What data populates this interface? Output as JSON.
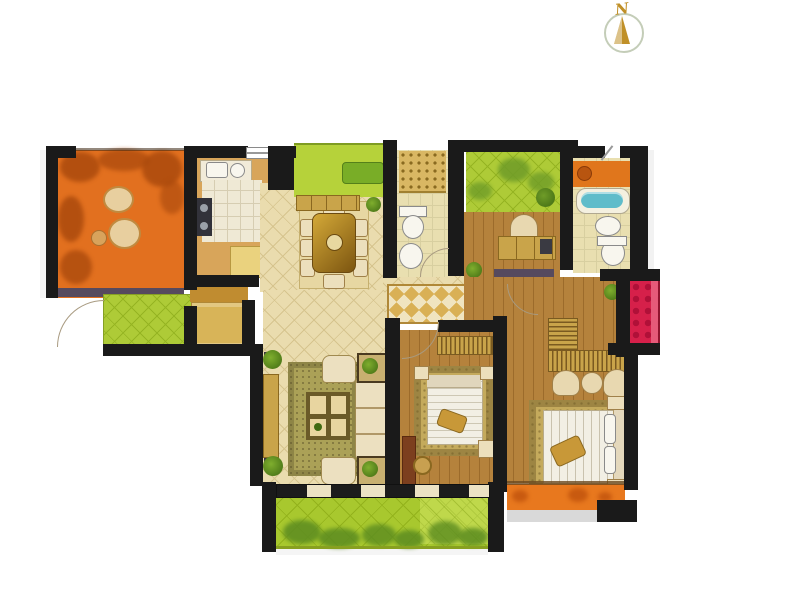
{
  "compass": {
    "label": "N"
  },
  "colors": {
    "wall": "#1a1a1a",
    "tile": "#eadcae",
    "tile_line": "#d6c48e",
    "wood": "#b5823c",
    "wood_dark": "#9c6b2b",
    "orange": "#e2701f",
    "orange_dark": "#a8480c",
    "terrace_slate": "#564a5e",
    "green": "#aecb37",
    "green_line": "#95b422",
    "green_dark": "#5c8c20",
    "lawn": "#a8c82e",
    "lawn_line": "#93b21c",
    "gold": "#c9a44a",
    "gold_dark": "#8a6820",
    "cream": "#ecdfbc",
    "cream_dark": "#a0814a",
    "red": "#d6204a",
    "pink": "#e8607e",
    "blue": "#5fbcca",
    "kitchen_floor": "#d8a55a",
    "bath_floor": "#e9dfb0",
    "bath_line": "#d8cfa0",
    "counter_orange": "#e0761c",
    "rug_olive": "#aba157",
    "rug_gold": "#c4aa5c",
    "mat_gold": "#d8b458",
    "runner_gold": "#d9b055",
    "runner_cream": "#f0e4c0",
    "fixture_border": "#8a8a8a",
    "arc": "#a89a80",
    "compass_gold": "#c09028",
    "compass_ring": "#c4cdb8",
    "shadow_grey": "#d9d9d9"
  }
}
